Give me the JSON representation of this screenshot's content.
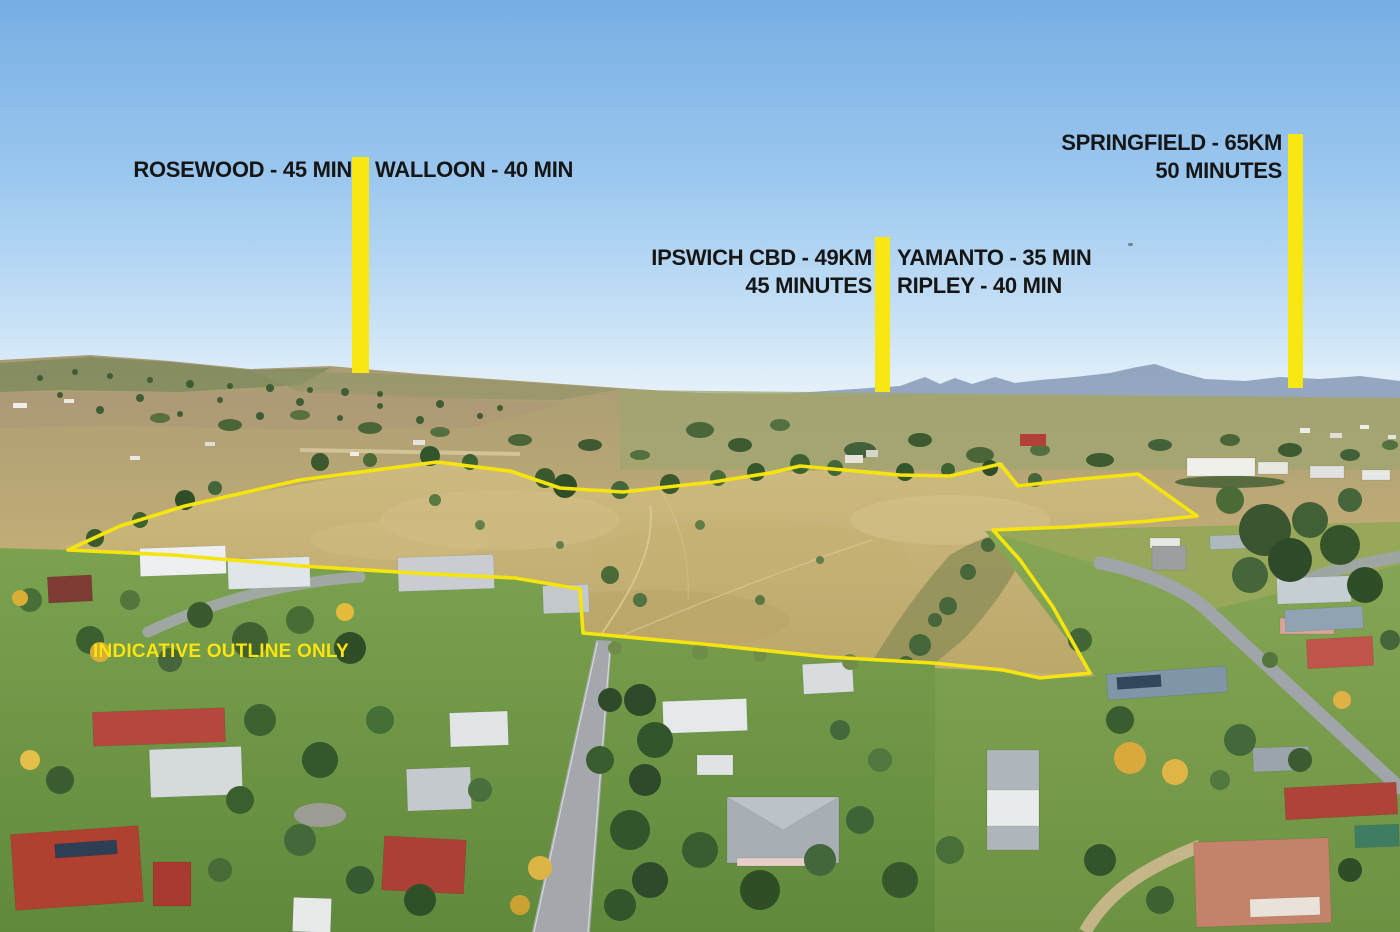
{
  "annotations": {
    "rosewood": "ROSEWOOD - 45 MIN",
    "walloon": "WALLOON - 40 MIN",
    "ipswich_line1": "IPSWICH CBD - 49KM",
    "ipswich_line2": "45 MINUTES",
    "yamanto": "YAMANTO - 35 MIN",
    "ripley": "RIPLEY - 40 MIN",
    "springfield_line1": "SPRINGFIELD - 65KM",
    "springfield_line2": "50 MINUTES",
    "disclaimer": "INDICATIVE OUTLINE ONLY"
  },
  "outline": {
    "points": "68,550 120,526 185,506 300,480 437,462 510,471 560,488 623,492 667,487 713,482 770,473 800,466 833,469 900,475 950,476 1000,464 1018,486 1070,480 1138,474 1197,516 1150,521 1067,527 993,530 1020,560 1053,607 1090,673 1040,678 1003,670 933,663 827,657 703,644 583,633 580,589 515,578 413,573 302,566 173,555"
  },
  "colors": {
    "marker_yellow": "#F8E712",
    "outline_yellow": "#F5E40E",
    "label_text": "#161616",
    "disclaimer_yellow": "#F8E512",
    "sky_top": "#77AEE4",
    "sky_horizon": "#E9F3FA"
  }
}
